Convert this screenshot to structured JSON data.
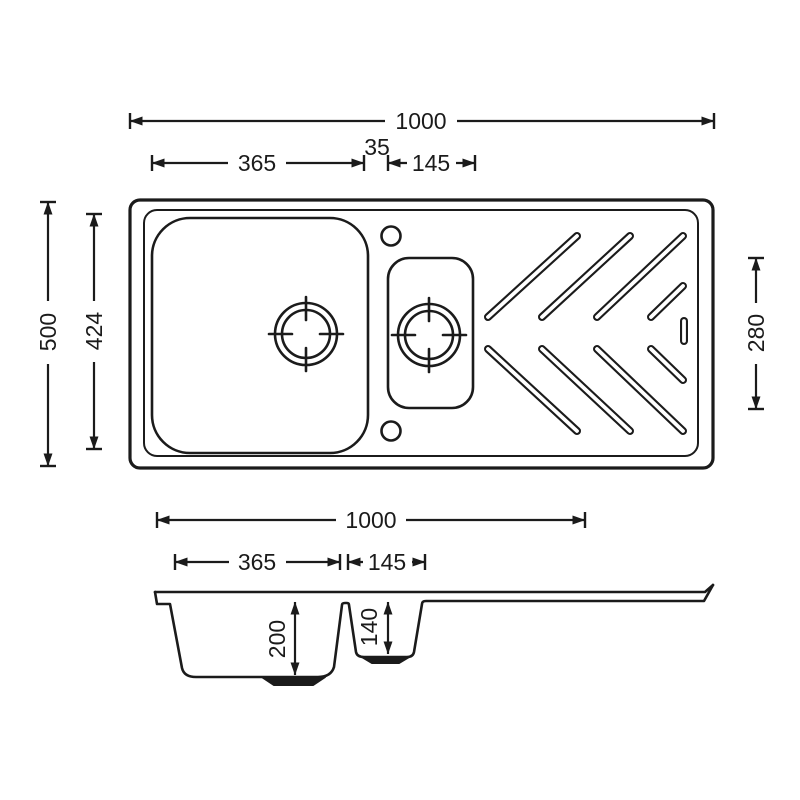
{
  "colors": {
    "line": "#1b1b1b",
    "background": "#ffffff"
  },
  "top_view": {
    "overall_width": "1000",
    "main_bowl_width": "365",
    "divider_width": "35",
    "half_bowl_width": "145",
    "overall_depth": "500",
    "main_bowl_length": "424",
    "half_bowl_length": "280"
  },
  "section_view": {
    "overall_width": "1000",
    "main_bowl_width": "365",
    "half_bowl_width": "145",
    "main_bowl_depth": "200",
    "half_bowl_depth": "140"
  }
}
